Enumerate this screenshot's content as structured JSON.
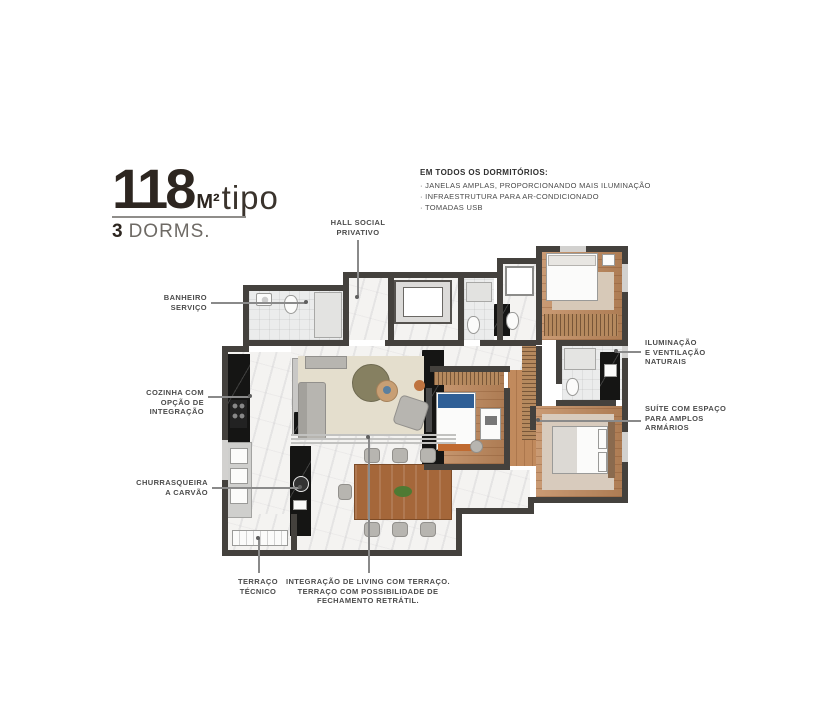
{
  "colors": {
    "accent_dark": "#2d2620",
    "label_text": "#4c4c4c",
    "wall": "#44413d",
    "wood_floor": "#c18a5d",
    "marble_floor": "#f4f3f1",
    "living_rug": "#e4decd",
    "black_marble": "#151514",
    "dining_table_wood": "#a5673a",
    "bed_accent_blue": "#2f5f96",
    "bench_accent_orange": "#c06a30"
  },
  "title": {
    "area_value": "118",
    "area_unit": "M²",
    "area_suffix": "tipo",
    "dorm_count": "3",
    "dorm_label": "DORMS."
  },
  "features_note": {
    "heading": "EM TODOS OS DORMITÓRIOS:",
    "items": [
      "· JANELAS AMPLAS, PROPORCIONANDO MAIS ILUMINAÇÃO",
      "· INFRAESTRUTURA PARA AR-CONDICIONADO",
      "· TOMADAS USB"
    ]
  },
  "callouts": {
    "hall": {
      "lines": [
        "HALL SOCIAL",
        "PRIVATIVO"
      ]
    },
    "banheiro": {
      "lines": [
        "BANHEIRO",
        "SERVIÇO"
      ]
    },
    "cozinha": {
      "lines": [
        "COZINHA COM",
        "OPÇÃO DE",
        "INTEGRAÇÃO"
      ]
    },
    "churrasqueira": {
      "lines": [
        "CHURRASQUEIRA",
        "A CARVÃO"
      ]
    },
    "terraco_tecnico": {
      "lines": [
        "TERRAÇO",
        "TÉCNICO"
      ]
    },
    "integracao": {
      "lines": [
        "INTEGRAÇÃO DE LIVING COM TERRAÇO.",
        "TERRAÇO COM POSSIBILIDADE DE",
        "FECHAMENTO RETRÁTIL."
      ]
    },
    "iluminacao": {
      "lines": [
        "ILUMINAÇÃO",
        "E VENTILAÇÃO",
        "NATURAIS"
      ]
    },
    "suite": {
      "lines": [
        "SUÍTE COM ESPAÇO",
        "PARA AMPLOS",
        "ARMÁRIOS"
      ]
    }
  }
}
